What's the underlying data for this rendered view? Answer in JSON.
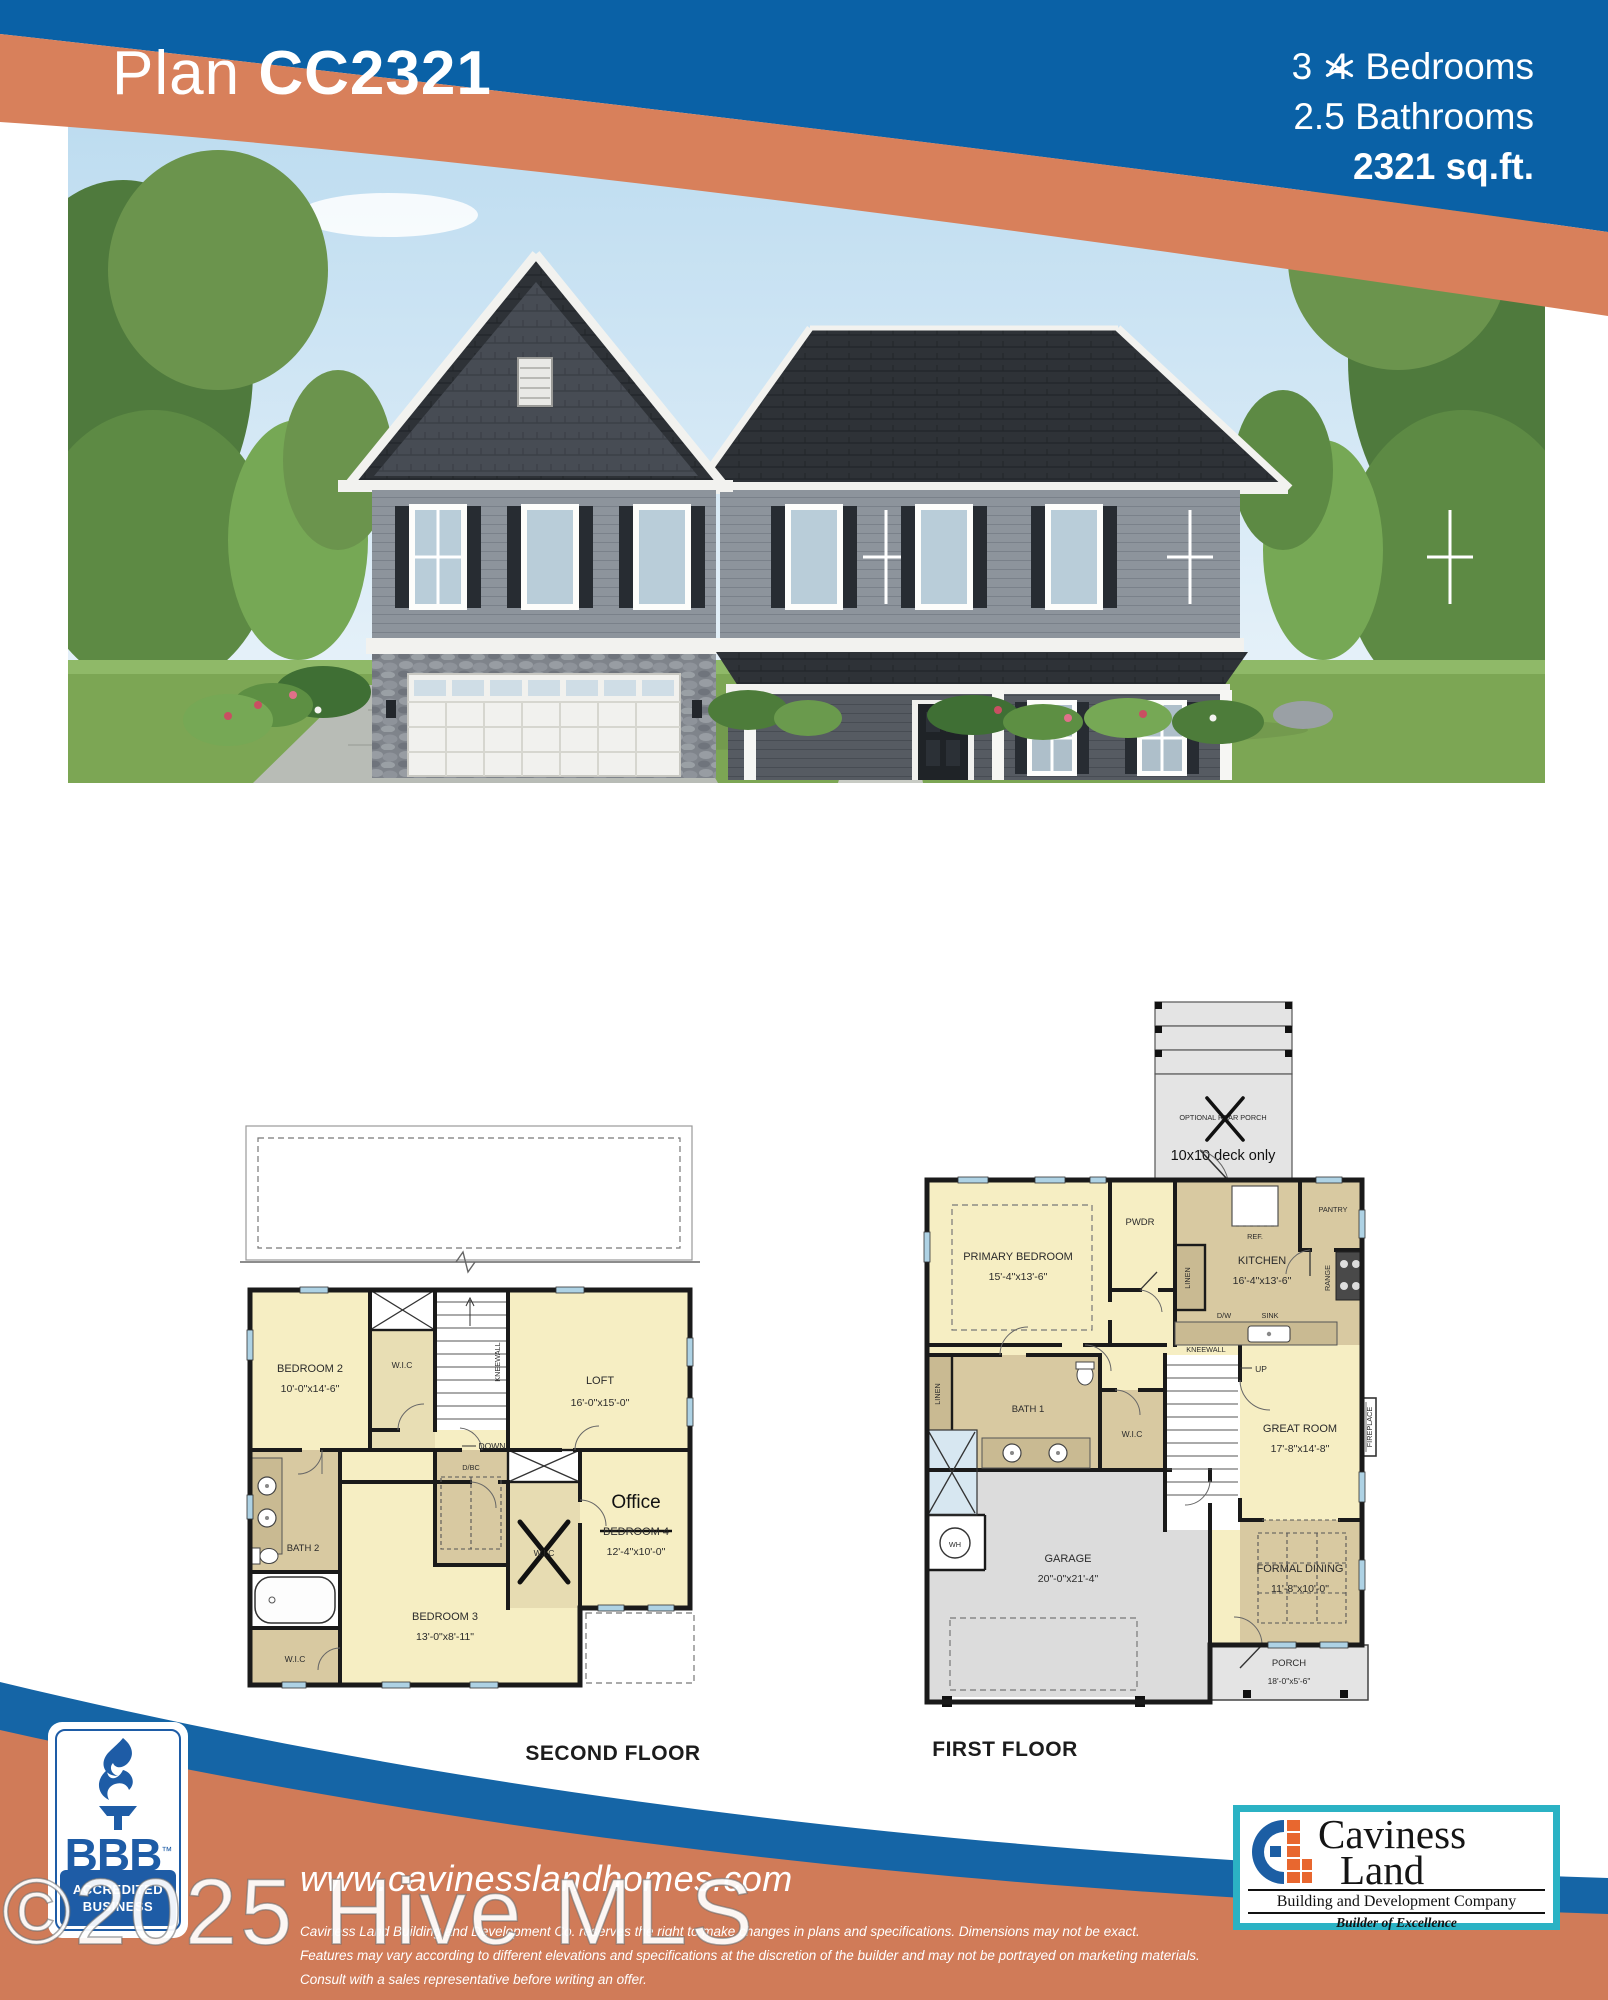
{
  "colors": {
    "header-blue": "#0a61a6",
    "swoosh-orange": "#d8805b",
    "footer-blue": "#1565a6",
    "footer-orange": "#d07b58",
    "plan-yellow": "#f6eec3",
    "plan-tan": "#d8c9a1",
    "plan-gray": "#dcdcdc",
    "wall": "#1a1a1a",
    "window-blue": "#aed2e4",
    "bbb-blue": "#1e5ca6",
    "logo-teal": "#2bb2c4",
    "logo-blue": "#1c5ea4",
    "logo-orange": "#e8672f"
  },
  "header": {
    "plan_word": "Plan",
    "plan_code": "CC2321",
    "bedrooms_new": "3",
    "bedrooms_old": "4",
    "bedrooms_word": "Bedrooms",
    "bathrooms": "2.5 Bathrooms",
    "sqft": "2321 sq.ft."
  },
  "plans": {
    "second": {
      "caption": "SECOND FLOOR",
      "rooms": {
        "bedroom2": {
          "name": "BEDROOM 2",
          "dims": "10'-0\"x14'-6\""
        },
        "wic_top": {
          "name": "W.I.C"
        },
        "loft": {
          "name": "LOFT",
          "dims": "16'-0\"x15'-0\""
        },
        "kneewall": {
          "name": "KNEEWALL"
        },
        "down": {
          "name": "DOWN"
        },
        "dbc": {
          "name": "D/BC"
        },
        "bath2": {
          "name": "BATH 2"
        },
        "wic_crossed": {
          "name": "W.I.C"
        },
        "office": {
          "name": "Office",
          "old_name": "BEDROOM 4",
          "dims": "12'-4\"x10'-0\""
        },
        "bedroom3": {
          "name": "BEDROOM 3",
          "dims": "13'-0\"x8'-11\""
        },
        "wic_bottom": {
          "name": "W.I.C"
        }
      }
    },
    "first": {
      "caption": "FIRST FLOOR",
      "rooms": {
        "deck": {
          "name": "OPTIONAL REAR PORCH",
          "note": "10x10 deck only"
        },
        "primary": {
          "name": "PRIMARY BEDROOM",
          "dims": "15'-4\"x13'-6\""
        },
        "pwdr": {
          "name": "PWDR"
        },
        "linen_hall": {
          "name": "LINEN"
        },
        "linen_left": {
          "name": "LINEN"
        },
        "kitchen": {
          "name": "KITCHEN",
          "dims": "16'-4\"x13'-6\""
        },
        "ref": {
          "name": "REF."
        },
        "pantry": {
          "name": "PANTRY"
        },
        "range": {
          "name": "RANGE"
        },
        "dw": {
          "name": "D/W"
        },
        "sink": {
          "name": "SINK"
        },
        "bath1": {
          "name": "BATH 1"
        },
        "wic": {
          "name": "W.I.C"
        },
        "wh": {
          "name": "WH"
        },
        "up": {
          "name": "UP"
        },
        "kneewall": {
          "name": "KNEEWALL"
        },
        "great": {
          "name": "GREAT ROOM",
          "dims": "17'-8\"x14'-8\""
        },
        "fireplace": {
          "name": "FIREPLACE"
        },
        "dining": {
          "name": "FORMAL DINING",
          "dims": "11'-8\"x10'-0\""
        },
        "garage": {
          "name": "GARAGE",
          "dims": "20\"-0\"x21'-4\""
        },
        "porch": {
          "name": "PORCH",
          "dims": "18'-0\"x5'-6\""
        }
      }
    }
  },
  "footer": {
    "website": "www.cavinesslandhomes.com",
    "disclaimer_line1": "Caviness Land Building and Development Co. reserves the right to make changes in plans and specifications. Dimensions may not be exact.",
    "disclaimer_line2": "Features may vary according to different elevations and specifications at the discretion of the builder and may not be portrayed on marketing materials.",
    "disclaimer_line3": "Consult with a sales representative before writing an offer.",
    "bbb": {
      "acronym": "BBB",
      "trademark": "™",
      "accredited": "ACCREDITED",
      "business": "BUSINESS"
    },
    "caviness": {
      "name_line1": "Caviness",
      "name_line2": "Land",
      "subtitle": "Building and Development Company",
      "tagline": "Builder of Excellence"
    }
  },
  "watermark": {
    "text": "©2025 Hive MLS"
  }
}
